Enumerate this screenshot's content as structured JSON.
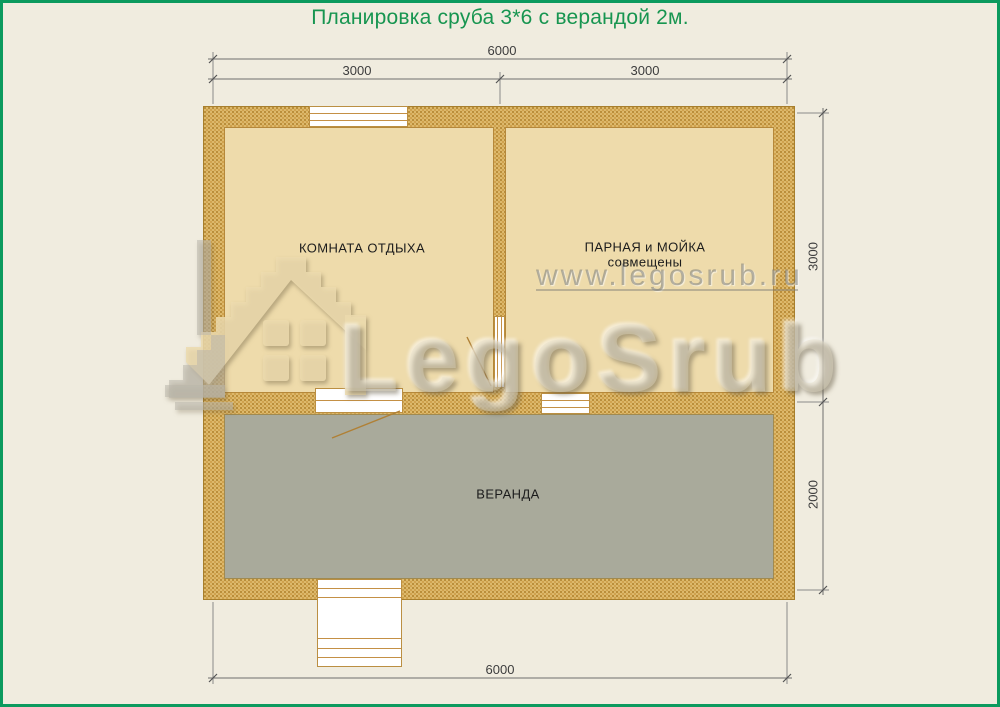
{
  "title": "Планировка сруба 3*6 с верандой 2м.",
  "rooms": {
    "rest": {
      "label": "КОМНАТА ОТДЫХА"
    },
    "steam": {
      "label": "ПАРНАЯ и МОЙКА",
      "sublabel": "совмещены"
    },
    "veranda": {
      "label": "ВЕРАНДА"
    }
  },
  "dimensions": {
    "top_total": "6000",
    "top_left": "3000",
    "top_right": "3000",
    "side_main": "3000",
    "side_veranda": "2000",
    "bottom_total": "6000"
  },
  "watermark": {
    "site": "www.legosrub.ru",
    "brand": "LegoSrub"
  },
  "colors": {
    "frame_green": "#0c9a5e",
    "title_green": "#179550",
    "wall_fill": "#ddb96c",
    "wall_line": "#a87f2c",
    "room_fill": "#eedbab",
    "veranda_fill": "#a9aa9b",
    "background": "#f0ecdf"
  }
}
